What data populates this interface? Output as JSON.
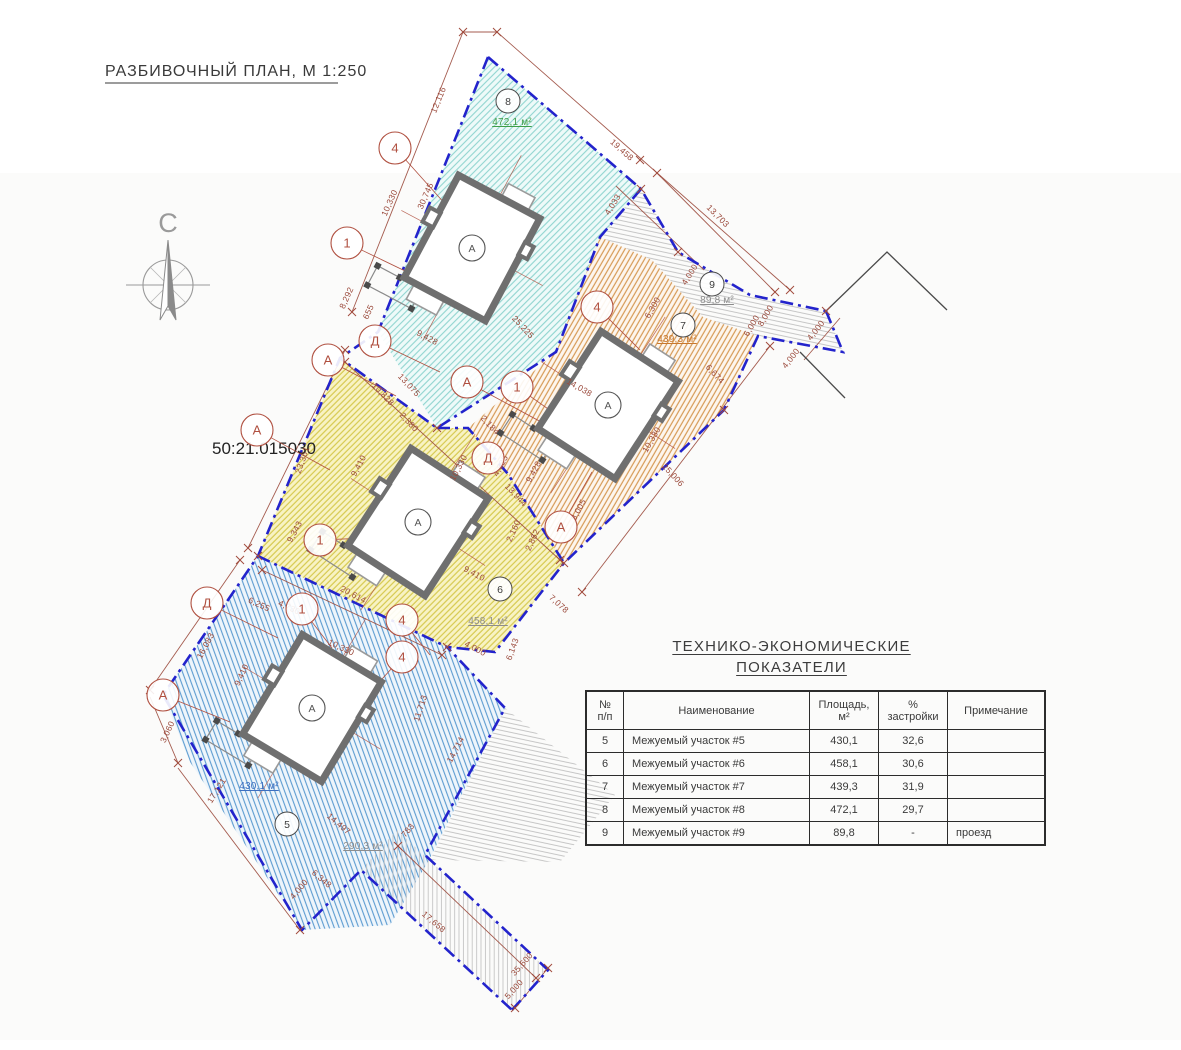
{
  "page": {
    "title": "РАЗБИВОЧНЫЙ ПЛАН, М 1:250",
    "north_label": "С",
    "cadastral_number": "50:21.015030"
  },
  "table": {
    "title_line1": "ТЕХНИКО-ЭКОНОМИЧЕСКИЕ",
    "title_line2": "ПОКАЗАТЕЛИ",
    "columns": [
      {
        "l1": "№",
        "l2": "п/п"
      },
      {
        "l1": "Наименование",
        "l2": ""
      },
      {
        "l1": "Площадь,",
        "l2": "м²"
      },
      {
        "l1": "%",
        "l2": "застройки"
      },
      {
        "l1": "Примечание",
        "l2": ""
      }
    ],
    "rows": [
      [
        "5",
        "Межуемый участок #5",
        "430,1",
        "32,6",
        ""
      ],
      [
        "6",
        "Межуемый участок #6",
        "458,1",
        "30,6",
        ""
      ],
      [
        "7",
        "Межуемый участок #7",
        "439,3",
        "31,9",
        ""
      ],
      [
        "8",
        "Межуемый участок #8",
        "472,1",
        "29,7",
        ""
      ],
      [
        "9",
        "Межуемый участок #9",
        "89,8",
        "-",
        "проезд"
      ]
    ]
  },
  "plan": {
    "colors": {
      "boundary_blue": "#2323cc",
      "dimension_red": "#9b4a3c",
      "axis_marker_red": "#b05040",
      "wall_grey": "#6f6f6f",
      "parcel5_hatch": "#5b9bd0",
      "parcel6_hatch": "#d6c94f",
      "parcel7_hatch": "#d69a55",
      "parcel8_hatch": "#8fd4cf",
      "parcel9_hatch": "#c0c0c0",
      "area_green": "#3f9e48",
      "area_orange": "#c8782d",
      "area_blue": "#3d6fc0",
      "area_grey": "#8d8d8d"
    },
    "area_labels": [
      {
        "t": "472,1 м²",
        "x": 512,
        "y": 125,
        "c": "#3f9e48"
      },
      {
        "t": "439,3 м²",
        "x": 677,
        "y": 342,
        "c": "#c8782d"
      },
      {
        "t": "458,1 м²",
        "x": 488,
        "y": 624,
        "c": "#8d8d8d"
      },
      {
        "t": "430,1 м²",
        "x": 259,
        "y": 789,
        "c": "#3d6fc0"
      },
      {
        "t": "89,8 м²",
        "x": 717,
        "y": 303,
        "c": "#8d8d8d"
      },
      {
        "t": "290,3 м²",
        "x": 363,
        "y": 849,
        "c": "#8d8d8d"
      }
    ],
    "dimensions": [
      {
        "t": "12,116",
        "x": 441,
        "y": 101,
        "r": -68
      },
      {
        "t": "19,458",
        "x": 620,
        "y": 152,
        "r": 42
      },
      {
        "t": "13,703",
        "x": 716,
        "y": 218,
        "r": 45
      },
      {
        "t": "4,033",
        "x": 615,
        "y": 206,
        "r": -58
      },
      {
        "t": "4,000",
        "x": 692,
        "y": 276,
        "r": -58
      },
      {
        "t": "6,000",
        "x": 754,
        "y": 327,
        "r": -60
      },
      {
        "t": "8,000",
        "x": 768,
        "y": 317,
        "r": -60
      },
      {
        "t": "4,000",
        "x": 818,
        "y": 332,
        "r": -52
      },
      {
        "t": "4,000",
        "x": 793,
        "y": 360,
        "r": -52
      },
      {
        "t": "10,330",
        "x": 392,
        "y": 204,
        "r": -66
      },
      {
        "t": "30,745",
        "x": 428,
        "y": 197,
        "r": -66
      },
      {
        "t": "8,292",
        "x": 349,
        "y": 299,
        "r": -66
      },
      {
        "t": "655",
        "x": 371,
        "y": 313,
        "r": -66
      },
      {
        "t": "9,428",
        "x": 426,
        "y": 340,
        "r": 28
      },
      {
        "t": "25,225",
        "x": 521,
        "y": 329,
        "r": 47
      },
      {
        "t": "13,075",
        "x": 407,
        "y": 387,
        "r": 47
      },
      {
        "t": "10,828",
        "x": 381,
        "y": 396,
        "r": 47
      },
      {
        "t": "2,380",
        "x": 407,
        "y": 424,
        "r": 47
      },
      {
        "t": "2,184",
        "x": 488,
        "y": 427,
        "r": 47
      },
      {
        "t": "4,625",
        "x": 503,
        "y": 467,
        "r": -62
      },
      {
        "t": "13,944",
        "x": 514,
        "y": 497,
        "r": 47
      },
      {
        "t": "9,428",
        "x": 536,
        "y": 473,
        "r": -62
      },
      {
        "t": "2,160",
        "x": 516,
        "y": 532,
        "r": -65
      },
      {
        "t": "2,862",
        "x": 535,
        "y": 541,
        "r": -65
      },
      {
        "t": "8,005",
        "x": 581,
        "y": 511,
        "r": -62
      },
      {
        "t": "14,038",
        "x": 578,
        "y": 390,
        "r": 30
      },
      {
        "t": "6,300",
        "x": 655,
        "y": 309,
        "r": -60
      },
      {
        "t": "10,330",
        "x": 654,
        "y": 441,
        "r": -60
      },
      {
        "t": "25,006",
        "x": 671,
        "y": 477,
        "r": 47
      },
      {
        "t": "6,674",
        "x": 713,
        "y": 376,
        "r": 47
      },
      {
        "t": "23,361",
        "x": 305,
        "y": 461,
        "r": -70
      },
      {
        "t": "9,343",
        "x": 297,
        "y": 533,
        "r": -62
      },
      {
        "t": "9,410",
        "x": 361,
        "y": 467,
        "r": -62
      },
      {
        "t": "10,330",
        "x": 461,
        "y": 469,
        "r": -62
      },
      {
        "t": "20,614",
        "x": 352,
        "y": 597,
        "r": 28
      },
      {
        "t": "9,410",
        "x": 473,
        "y": 576,
        "r": 28
      },
      {
        "t": "7,078",
        "x": 557,
        "y": 606,
        "r": 42
      },
      {
        "t": "6,143",
        "x": 515,
        "y": 650,
        "r": -70
      },
      {
        "t": "4,000",
        "x": 474,
        "y": 651,
        "r": 28
      },
      {
        "t": "16,083",
        "x": 208,
        "y": 647,
        "r": -62
      },
      {
        "t": "6,255",
        "x": 258,
        "y": 607,
        "r": 25
      },
      {
        "t": "4,730",
        "x": 288,
        "y": 610,
        "r": 25
      },
      {
        "t": "10,330",
        "x": 340,
        "y": 650,
        "r": 25
      },
      {
        "t": "9,410",
        "x": 244,
        "y": 676,
        "r": -65
      },
      {
        "t": "3,060",
        "x": 170,
        "y": 733,
        "r": -65
      },
      {
        "t": "17,121",
        "x": 219,
        "y": 792,
        "r": -58
      },
      {
        "t": "11,713",
        "x": 423,
        "y": 709,
        "r": -72
      },
      {
        "t": "14,714",
        "x": 458,
        "y": 751,
        "r": -62
      },
      {
        "t": "14,497",
        "x": 337,
        "y": 826,
        "r": 40
      },
      {
        "t": "783",
        "x": 410,
        "y": 832,
        "r": -50
      },
      {
        "t": "6,348",
        "x": 320,
        "y": 881,
        "r": 40
      },
      {
        "t": "4,000",
        "x": 301,
        "y": 891,
        "r": -50
      },
      {
        "t": "17,658",
        "x": 432,
        "y": 924,
        "r": 40
      },
      {
        "t": "35,600",
        "x": 524,
        "y": 966,
        "r": -48
      },
      {
        "t": "5,000",
        "x": 516,
        "y": 991,
        "r": -48
      }
    ],
    "axis_markers": [
      {
        "t": "4",
        "x": 395,
        "y": 148,
        "tx": 455,
        "ty": 215
      },
      {
        "t": "1",
        "x": 347,
        "y": 243,
        "tx": 428,
        "ty": 282
      },
      {
        "t": "Д",
        "x": 375,
        "y": 341,
        "tx": 440,
        "ty": 372
      },
      {
        "t": "А",
        "x": 328,
        "y": 360,
        "tx": 396,
        "ty": 396
      },
      {
        "t": "А",
        "x": 467,
        "y": 382,
        "tx": 556,
        "ty": 430
      },
      {
        "t": "1",
        "x": 517,
        "y": 387,
        "tx": 575,
        "ty": 428
      },
      {
        "t": "4",
        "x": 597,
        "y": 307,
        "tx": 640,
        "ty": 350
      },
      {
        "t": "А",
        "x": 257,
        "y": 430,
        "tx": 330,
        "ty": 470
      },
      {
        "t": "1",
        "x": 320,
        "y": 540,
        "tx": 368,
        "ty": 538
      },
      {
        "t": "Д",
        "x": 488,
        "y": 458,
        "tx": 462,
        "ty": 492
      },
      {
        "t": "А",
        "x": 561,
        "y": 527,
        "tx": 592,
        "ty": 472
      },
      {
        "t": "Д",
        "x": 207,
        "y": 603,
        "tx": 278,
        "ty": 638
      },
      {
        "t": "1",
        "x": 302,
        "y": 609,
        "tx": 332,
        "ty": 648
      },
      {
        "t": "4",
        "x": 402,
        "y": 620,
        "tx": 430,
        "ty": 655
      },
      {
        "t": "4",
        "x": 402,
        "y": 657,
        "tx": 372,
        "ty": 690
      },
      {
        "t": "А",
        "x": 163,
        "y": 695,
        "tx": 230,
        "ty": 722
      }
    ],
    "parcel_markers": [
      {
        "t": "8",
        "x": 508,
        "y": 101
      },
      {
        "t": "9",
        "x": 712,
        "y": 284
      },
      {
        "t": "7",
        "x": 683,
        "y": 325
      },
      {
        "t": "6",
        "x": 500,
        "y": 589
      },
      {
        "t": "5",
        "x": 287,
        "y": 824
      }
    ],
    "buildings": [
      {
        "label": "А",
        "x": 472,
        "y": 248,
        "r": 28
      },
      {
        "label": "А",
        "x": 608,
        "y": 405,
        "r": 33
      },
      {
        "label": "А",
        "x": 418,
        "y": 522,
        "r": 33
      },
      {
        "label": "А",
        "x": 312,
        "y": 708,
        "r": 31
      }
    ],
    "ticks": [
      [
        463,
        32
      ],
      [
        352,
        312
      ],
      [
        497,
        32
      ],
      [
        640,
        160
      ],
      [
        790,
        290
      ],
      [
        657,
        173
      ],
      [
        775,
        292
      ],
      [
        345,
        350
      ],
      [
        248,
        548
      ],
      [
        240,
        560
      ],
      [
        150,
        690
      ],
      [
        178,
        763
      ],
      [
        300,
        930
      ],
      [
        770,
        346
      ],
      [
        582,
        592
      ],
      [
        398,
        846
      ],
      [
        536,
        978
      ],
      [
        548,
        968
      ],
      [
        515,
        1008
      ],
      [
        262,
        570
      ],
      [
        442,
        655
      ],
      [
        345,
        362
      ],
      [
        560,
        560
      ],
      [
        724,
        410
      ],
      [
        564,
        563
      ],
      [
        826,
        311
      ],
      [
        678,
        252
      ],
      [
        641,
        189
      ],
      [
        437,
        428
      ],
      [
        258,
        556
      ],
      [
        447,
        647
      ]
    ]
  }
}
